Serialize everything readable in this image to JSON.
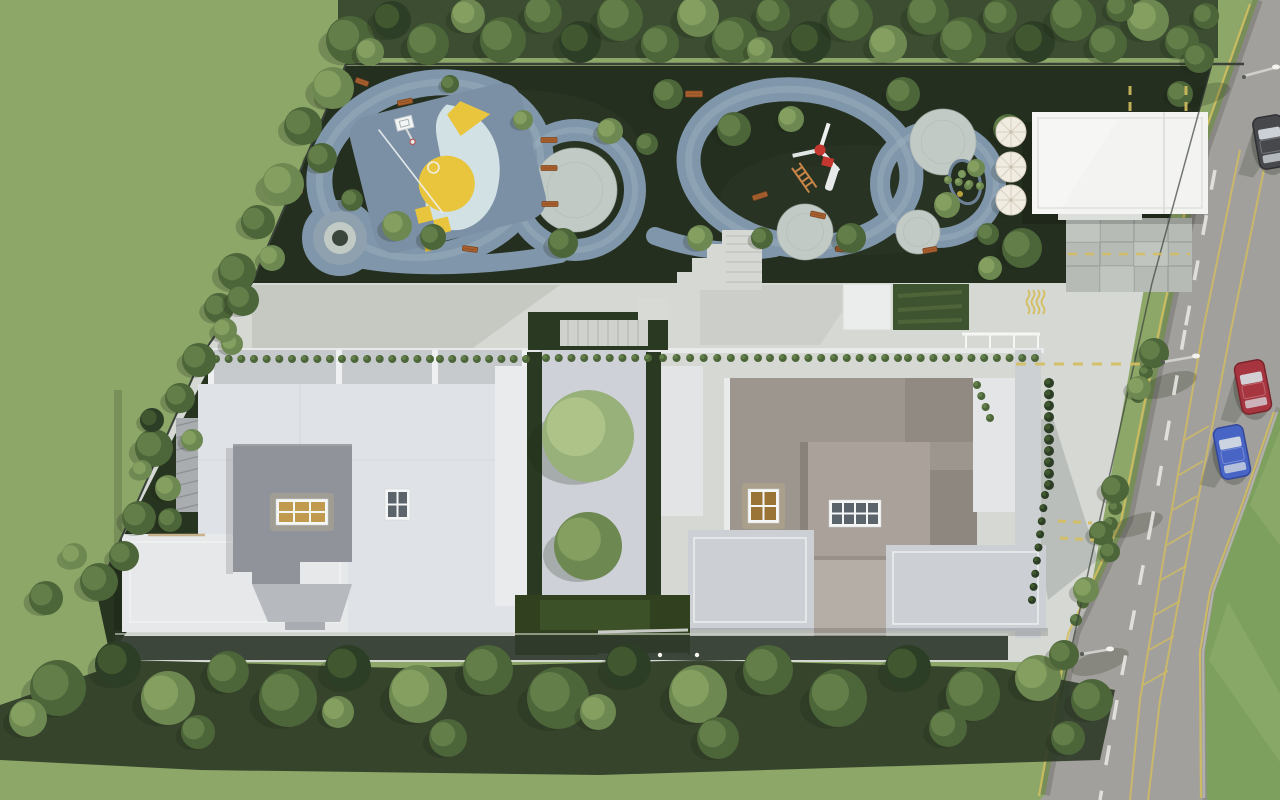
{
  "scene": {
    "type": "aerial-architectural-site-render",
    "palette": {
      "lawn": "#8da769",
      "lawn_road": "#7ea05f",
      "lawn_road_light": "#90ad6e",
      "ground_dark": "#242f20",
      "ground_moss": "#33402a",
      "track": "#8096aa",
      "track_hi": "#a7b9c6",
      "plaza": "#c2cac5",
      "plaza_ring": "#8fa0ae",
      "plaza_core": "#3a453b",
      "court_base": "#7b90a5",
      "court_pale": "#d2e1e4",
      "court_yellow": "#e9c53d",
      "bench": "#a9602f",
      "bench_dark": "#7c4520",
      "fence": "#3a423a",
      "esplanade": "#d6d8d3",
      "paving_tile": "#b6bbb6",
      "tile_line": "#989e99",
      "pavilion": "#f3f4f2",
      "umbrella": "#f0ece1",
      "umbrella_line": "#d8d1c0",
      "turf_panel": "#3e5330",
      "turf_light": "#55693c",
      "hedge": "#2a3a22",
      "hedge_core": "#31411f",
      "hedge_inner": "#3d5128",
      "court_yard": "#ced1d7",
      "roofL": "#dfe2e6",
      "slabL": "#e6e8ea",
      "terraceL": "#c6cacd",
      "volume_dark": "#90949a",
      "volume_mid": "#b6b9be",
      "roofR": "#9d968e",
      "roofR_light": "#aaa29a",
      "roofR_shade": "#7e7872",
      "annex": "#e3e5e6",
      "terrace": "#ccd0d4",
      "apronR": "#b4aea7",
      "walk_dark": "#2f3a2c",
      "wall_louver": "#a9adaf",
      "window_frame": "#f5f6f6",
      "window_warm": "#c09a4e",
      "window_warm2": "#9a7336",
      "window_cool": "#5b636b",
      "glow": "#e8c87a",
      "road": "#a2a09c",
      "road_edge": "#8f8d89",
      "yellow": "#d4be5e",
      "white_line": "#e7e6e2",
      "curb": "#bab8b3",
      "car_red": "#a73540",
      "car_red_dark": "#7c232c",
      "car_blue": "#4865c6",
      "car_blue_dark": "#32479a",
      "car_dark": "#46484c",
      "car_dark_dark": "#2e3033",
      "glass": "#d7dde2",
      "pole": "#cfd0cd",
      "lamp": "#f4f4ee",
      "equip_red": "#c5372f",
      "ladder": "#c98548",
      "shadow": "#1c2414",
      "white": "#f6f7f4",
      "stair_light": "#cfd2cd",
      "stair_line": "#b2b6b0",
      "tree_tones": [
        [
          "#2c3e25",
          "#41582f"
        ],
        [
          "#4c6539",
          "#64804a"
        ],
        [
          "#6e8851",
          "#85a061"
        ],
        [
          "#98b079",
          "#aec489"
        ]
      ]
    },
    "trees": {
      "layer-trees-top": [
        [
          350,
          40,
          24,
          1
        ],
        [
          392,
          20,
          19,
          0
        ],
        [
          428,
          44,
          21,
          1
        ],
        [
          468,
          16,
          17,
          2
        ],
        [
          503,
          40,
          23,
          1
        ],
        [
          543,
          14,
          19,
          1
        ],
        [
          580,
          42,
          21,
          0
        ],
        [
          620,
          18,
          23,
          1
        ],
        [
          660,
          44,
          19,
          1
        ],
        [
          698,
          16,
          21,
          2
        ],
        [
          735,
          40,
          23,
          1
        ],
        [
          773,
          14,
          17,
          1
        ],
        [
          810,
          42,
          21,
          0
        ],
        [
          850,
          18,
          23,
          1
        ],
        [
          888,
          44,
          19,
          2
        ],
        [
          928,
          14,
          21,
          1
        ],
        [
          963,
          40,
          23,
          1
        ],
        [
          1000,
          16,
          17,
          1
        ],
        [
          1034,
          42,
          21,
          0
        ],
        [
          1073,
          18,
          23,
          1
        ],
        [
          1108,
          44,
          19,
          1
        ],
        [
          1148,
          20,
          21,
          2
        ],
        [
          1182,
          42,
          17,
          1
        ],
        [
          1206,
          16,
          13,
          1
        ],
        [
          370,
          52,
          14,
          2
        ],
        [
          760,
          50,
          13,
          2
        ],
        [
          1120,
          8,
          14,
          1
        ]
      ],
      "layer-trees-left": [
        [
          333,
          88,
          21,
          2
        ],
        [
          303,
          126,
          19,
          1
        ],
        [
          322,
          158,
          15,
          1
        ],
        [
          283,
          184,
          21,
          2
        ],
        [
          258,
          222,
          17,
          1
        ],
        [
          272,
          258,
          13,
          2
        ],
        [
          237,
          272,
          19,
          1
        ],
        [
          219,
          308,
          15,
          1
        ],
        [
          232,
          344,
          11,
          2
        ],
        [
          199,
          360,
          17,
          1
        ],
        [
          180,
          398,
          15,
          1
        ],
        [
          154,
          448,
          19,
          1
        ],
        [
          168,
          488,
          13,
          2
        ],
        [
          139,
          518,
          17,
          1
        ],
        [
          124,
          556,
          15,
          1
        ],
        [
          99,
          582,
          19,
          1
        ],
        [
          74,
          556,
          13,
          2
        ],
        [
          46,
          598,
          17,
          1
        ],
        [
          152,
          420,
          12,
          0
        ],
        [
          192,
          440,
          11,
          2
        ],
        [
          170,
          520,
          12,
          1
        ],
        [
          142,
          470,
          10,
          2
        ],
        [
          243,
          300,
          16,
          1
        ],
        [
          225,
          330,
          12,
          2
        ]
      ],
      "layer-trees-bottom": [
        [
          58,
          688,
          28,
          1
        ],
        [
          118,
          664,
          23,
          0
        ],
        [
          168,
          698,
          27,
          2
        ],
        [
          228,
          672,
          21,
          1
        ],
        [
          288,
          698,
          29,
          1
        ],
        [
          348,
          668,
          23,
          0
        ],
        [
          418,
          694,
          29,
          2
        ],
        [
          488,
          670,
          25,
          1
        ],
        [
          558,
          698,
          31,
          1
        ],
        [
          628,
          666,
          23,
          0
        ],
        [
          698,
          694,
          29,
          2
        ],
        [
          768,
          670,
          25,
          1
        ],
        [
          838,
          698,
          29,
          1
        ],
        [
          908,
          668,
          23,
          0
        ],
        [
          973,
          694,
          27,
          1
        ],
        [
          1038,
          678,
          23,
          2
        ],
        [
          1092,
          700,
          21,
          1
        ],
        [
          28,
          718,
          19,
          2
        ],
        [
          198,
          732,
          17,
          1
        ],
        [
          448,
          738,
          19,
          1
        ],
        [
          718,
          738,
          21,
          1
        ],
        [
          948,
          728,
          19,
          1
        ],
        [
          1068,
          738,
          17,
          1
        ],
        [
          598,
          712,
          18,
          2
        ],
        [
          338,
          712,
          16,
          2
        ]
      ],
      "layer-trees-playground": [
        [
          397,
          226,
          15,
          2
        ],
        [
          352,
          200,
          11,
          1
        ],
        [
          433,
          237,
          13,
          1
        ],
        [
          563,
          243,
          15,
          1
        ],
        [
          610,
          131,
          13,
          2
        ],
        [
          647,
          144,
          11,
          1
        ],
        [
          668,
          94,
          15,
          1
        ],
        [
          700,
          238,
          13,
          2
        ],
        [
          734,
          129,
          17,
          1
        ],
        [
          762,
          238,
          11,
          1
        ],
        [
          791,
          119,
          13,
          2
        ],
        [
          851,
          238,
          15,
          1
        ],
        [
          903,
          94,
          17,
          1
        ],
        [
          947,
          205,
          13,
          2
        ],
        [
          988,
          234,
          11,
          1
        ],
        [
          1008,
          129,
          15,
          1
        ],
        [
          976,
          168,
          9,
          2
        ],
        [
          331,
          96,
          13,
          1
        ],
        [
          523,
          120,
          10,
          2
        ],
        [
          450,
          84,
          9,
          1
        ],
        [
          1022,
          248,
          20,
          1
        ],
        [
          990,
          268,
          12,
          2
        ]
      ],
      "layer-trees-road": [
        [
          1199,
          58,
          15,
          1
        ],
        [
          1180,
          94,
          13,
          1
        ],
        [
          1154,
          353,
          15,
          1
        ],
        [
          1139,
          388,
          12,
          2
        ],
        [
          1115,
          489,
          14,
          1
        ],
        [
          1101,
          533,
          12,
          1
        ],
        [
          1086,
          590,
          13,
          2
        ],
        [
          1110,
          552,
          10,
          1
        ],
        [
          1064,
          655,
          15,
          1
        ]
      ],
      "layer-trees-courtyard": [
        [
          588,
          436,
          46,
          3
        ],
        [
          588,
          546,
          34,
          2
        ]
      ]
    },
    "shrub_rows": [
      {
        "x1": 216,
        "y1": 359,
        "x2": 330,
        "y2": 359,
        "n": 10,
        "r": 4,
        "tone": 1
      },
      {
        "x1": 342,
        "y1": 359,
        "x2": 430,
        "y2": 359,
        "n": 8,
        "r": 4,
        "tone": 1
      },
      {
        "x1": 440,
        "y1": 359,
        "x2": 526,
        "y2": 359,
        "n": 8,
        "r": 4,
        "tone": 1
      },
      {
        "x1": 546,
        "y1": 358,
        "x2": 648,
        "y2": 358,
        "n": 9,
        "r": 4,
        "tone": 1
      },
      {
        "x1": 663,
        "y1": 358,
        "x2": 758,
        "y2": 358,
        "n": 8,
        "r": 4,
        "tone": 1
      },
      {
        "x1": 770,
        "y1": 358,
        "x2": 898,
        "y2": 358,
        "n": 11,
        "r": 4,
        "tone": 1
      },
      {
        "x1": 908,
        "y1": 358,
        "x2": 1035,
        "y2": 358,
        "n": 11,
        "r": 4,
        "tone": 1
      },
      {
        "x1": 977,
        "y1": 385,
        "x2": 990,
        "y2": 418,
        "n": 4,
        "r": 4,
        "tone": 1
      },
      {
        "x1": 1049,
        "y1": 383,
        "x2": 1049,
        "y2": 485,
        "n": 10,
        "r": 5,
        "tone": 0
      },
      {
        "x1": 1045,
        "y1": 495,
        "x2": 1032,
        "y2": 600,
        "n": 9,
        "r": 4,
        "tone": 0
      },
      {
        "x1": 1150,
        "y1": 360,
        "x2": 1138,
        "y2": 396,
        "n": 4,
        "r": 7,
        "tone": 1
      },
      {
        "x1": 1120,
        "y1": 492,
        "x2": 1106,
        "y2": 540,
        "n": 4,
        "r": 7,
        "tone": 1
      },
      {
        "x1": 1090,
        "y1": 585,
        "x2": 1076,
        "y2": 620,
        "n": 3,
        "r": 6,
        "tone": 1
      },
      {
        "x1": 948,
        "y1": 180,
        "x2": 980,
        "y2": 186,
        "n": 4,
        "r": 4,
        "tone": 2
      }
    ],
    "benches": [
      [
        405,
        102,
        15,
        5,
        -12
      ],
      [
        300,
        186,
        5,
        15,
        0
      ],
      [
        470,
        249,
        15,
        5,
        8
      ],
      [
        549,
        140,
        16,
        5,
        0
      ],
      [
        549,
        168,
        16,
        5,
        0
      ],
      [
        550,
        204,
        16,
        5,
        0
      ],
      [
        694,
        94,
        17,
        6,
        0
      ],
      [
        760,
        196,
        15,
        5,
        -18
      ],
      [
        818,
        215,
        15,
        5,
        12
      ],
      [
        843,
        249,
        15,
        5,
        0
      ],
      [
        362,
        82,
        13,
        5,
        20
      ],
      [
        930,
        250,
        14,
        5,
        -10
      ]
    ],
    "umbrellas": [
      [
        1011,
        132,
        15
      ],
      [
        1011,
        167,
        15
      ],
      [
        1011,
        200,
        15
      ]
    ],
    "plazas": [
      [
        575,
        190,
        42
      ],
      [
        805,
        232,
        28
      ],
      [
        943,
        142,
        33
      ],
      [
        918,
        232,
        22
      ]
    ],
    "windows": [
      {
        "x": 276,
        "y": 499,
        "w": 52,
        "h": 26,
        "cols": 3,
        "rows": 2,
        "pane": "window_warm"
      },
      {
        "x": 385,
        "y": 489,
        "w": 25,
        "h": 31,
        "cols": 2,
        "rows": 2,
        "pane": "window_cool"
      },
      {
        "x": 748,
        "y": 489,
        "w": 31,
        "h": 34,
        "cols": 2,
        "rows": 2,
        "pane": "window_warm2"
      },
      {
        "x": 829,
        "y": 500,
        "w": 52,
        "h": 27,
        "cols": 4,
        "rows": 2,
        "pane": "window_cool"
      }
    ],
    "cars": [
      {
        "x": 1253,
        "y": 387,
        "rot": -11,
        "body": "car_red",
        "dark": "car_red_dark"
      },
      {
        "x": 1232,
        "y": 452,
        "rot": -11,
        "body": "car_blue",
        "dark": "car_blue_dark"
      },
      {
        "x": 1271,
        "y": 142,
        "rot": -10,
        "body": "car_dark",
        "dark": "car_dark_dark"
      }
    ],
    "dash_lines": [
      {
        "pts": [
          [
            1016,
            364
          ],
          [
            1140,
            364
          ]
        ],
        "seg": 10,
        "gap": 9,
        "w": 3,
        "color": "yellow"
      },
      {
        "pts": [
          [
            1058,
            521
          ],
          [
            1092,
            523
          ]
        ],
        "seg": 8,
        "gap": 7,
        "w": 3,
        "color": "yellow"
      },
      {
        "pts": [
          [
            1060,
            538
          ],
          [
            1094,
            540
          ]
        ],
        "seg": 8,
        "gap": 7,
        "w": 3,
        "color": "yellow"
      },
      {
        "pts": [
          [
            1130,
            86
          ],
          [
            1130,
            114
          ]
        ],
        "seg": 9,
        "gap": 7,
        "w": 3,
        "color": "yellow"
      },
      {
        "pts": [
          [
            1186,
            86
          ],
          [
            1186,
            114
          ]
        ],
        "seg": 9,
        "gap": 7,
        "w": 3,
        "color": "yellow"
      },
      {
        "pts": [
          [
            1068,
            254
          ],
          [
            1190,
            254
          ]
        ],
        "seg": 9,
        "gap": 8,
        "w": 2.5,
        "color": "yellow"
      },
      {
        "pts": [
          [
            1215,
            170
          ],
          [
            1185,
            330
          ],
          [
            1152,
            520
          ],
          [
            1117,
            700
          ],
          [
            1100,
            800
          ]
        ],
        "seg": 20,
        "gap": 26,
        "w": 3.5,
        "color": "white_line"
      }
    ]
  }
}
